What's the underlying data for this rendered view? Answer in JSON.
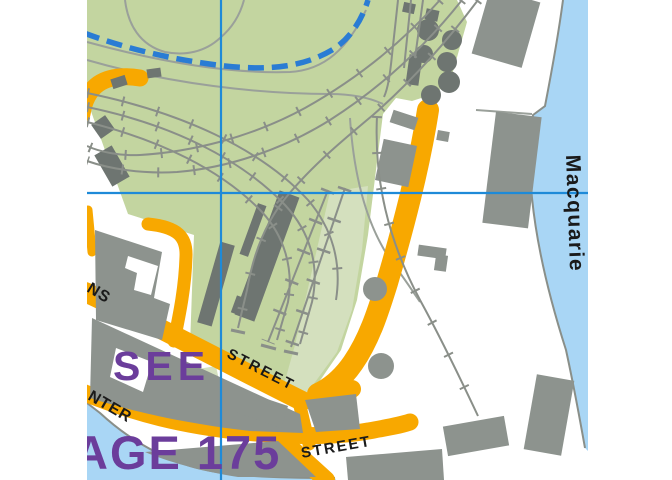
{
  "map": {
    "labels": {
      "page_ref_line1": "SEE",
      "page_ref_line2": "AGE 175",
      "street_upper": "STREET",
      "street_lower": "STREET",
      "street_left_partial": "NS",
      "street_lower_left_partial": "NTER",
      "waterfront_street": "Macquarie"
    },
    "colors": {
      "paper": "#ffffff",
      "parkland": "#c3d5a0",
      "parkland_light": "#d4e0be",
      "water": "#a9d6f5",
      "road": "#f8a800",
      "building": "#8d938e",
      "building_dark": "#6e7571",
      "rail": "#8a8f89",
      "path": "#9aa09a",
      "grid_blue": "#1e8ad8",
      "route_blue": "#2a7cd4",
      "page_ref_purple": "#6b3d9b",
      "label_black": "#1a1a1a"
    }
  }
}
